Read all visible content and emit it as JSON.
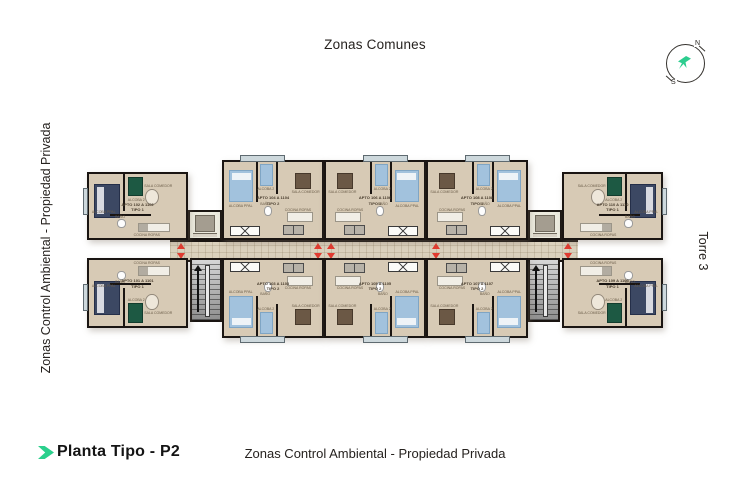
{
  "page": {
    "background": "#ffffff"
  },
  "header": {
    "title": "Zonas Comunes"
  },
  "compass": {
    "north": "N",
    "south": "S",
    "arrow_color": "#2dcd8f"
  },
  "side_labels": {
    "left_vertical": "Zonas Control Ambiental - Propiedad Privada",
    "right_vertical": "Torre 3"
  },
  "footer": {
    "plan_title": "Planta Tipo - P2",
    "center_label": "Zonas Control Ambiental - Propiedad Privada"
  },
  "floorplan": {
    "room_labels": {
      "ppal": "ALCOBA PPAL",
      "alc2": "ALCOBA 2",
      "bano": "BAÑO",
      "sala": "SALA COMEDOR",
      "cocina": "COCINA ROPAS"
    },
    "units": [
      {
        "id": "apto-102",
        "line1": "APTO 102 A 1102",
        "line2": "TIPO 1"
      },
      {
        "id": "apto-104",
        "line1": "APTO 104 A 1104",
        "line2": "TIPO 2"
      },
      {
        "id": "apto-106",
        "line1": "APTO 106 A 1106",
        "line2": "TIPO 2"
      },
      {
        "id": "apto-108",
        "line1": "APTO 108 A 1108",
        "line2": "TIPO 2"
      },
      {
        "id": "apto-110",
        "line1": "APTO 110 A 1110",
        "line2": "TIPO 1"
      },
      {
        "id": "apto-101",
        "line1": "APTO 101 A 1101",
        "line2": "TIPO 1"
      },
      {
        "id": "apto-103",
        "line1": "APTO 103 A 1103",
        "line2": "TIPO 2"
      },
      {
        "id": "apto-105",
        "line1": "APTO 105 A 1105",
        "line2": "TIPO 2"
      },
      {
        "id": "apto-107",
        "line1": "APTO 107 A 1107",
        "line2": "TIPO 2"
      },
      {
        "id": "apto-109",
        "line1": "APTO 109 A 1109",
        "line2": "TIPO 1"
      }
    ],
    "colors": {
      "wall": "#1a1512",
      "floor": "#d7cab5",
      "corridor": "#dbd1bd",
      "entry_arrow": "#e23b30",
      "accent_green": "#2bd08d",
      "bed_navy": "#3c4863",
      "bed_blue": "#a2c2dd",
      "bed_green": "#1d5943"
    }
  }
}
